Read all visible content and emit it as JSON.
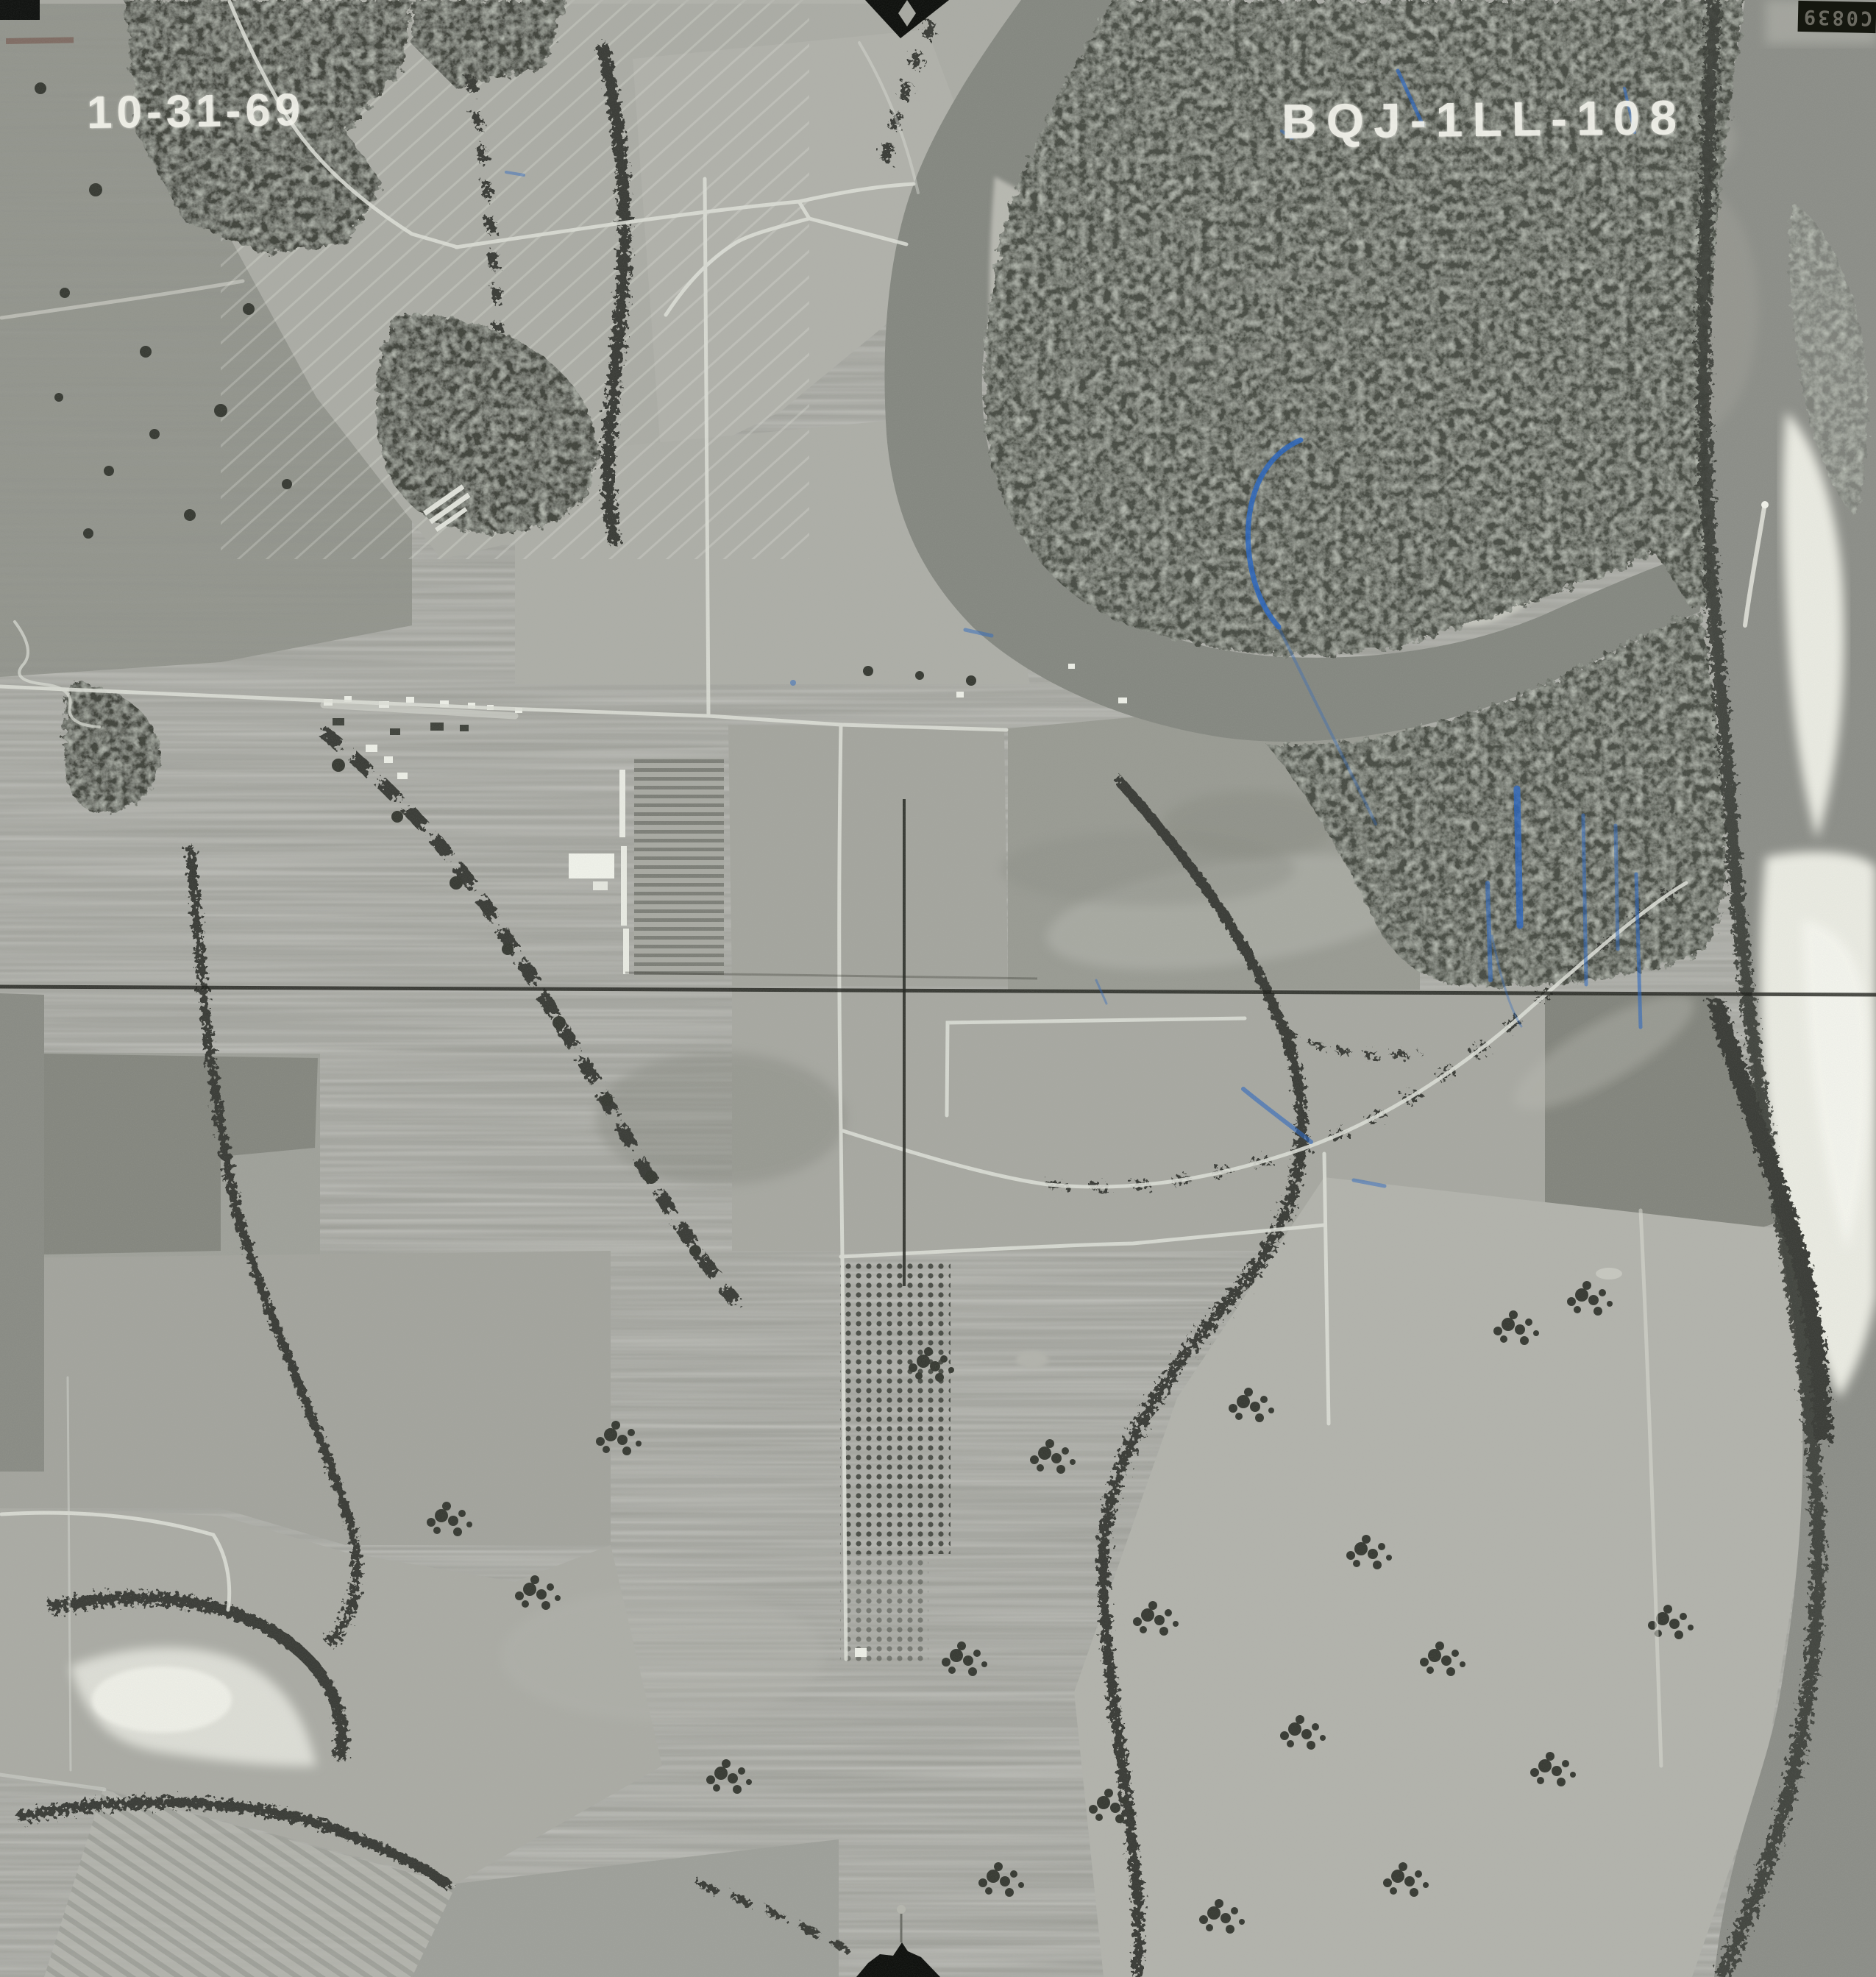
{
  "photo": {
    "date_stamp": "10-31-69",
    "photo_id_stamp": "BQJ-1LL-108",
    "film_edge_number": "C0839",
    "colors": {
      "stamp_white": "#f1f1ea",
      "ink_blue": "#2b67c0",
      "fiducial_black": "#0e100d",
      "water_gray": "#8c8e88",
      "oxbow_water_gray": "#858881",
      "sand_white": "#e9eae1",
      "forest_dark_gray": "#4a4d45",
      "field_light_gray": "#a6a7a1"
    }
  }
}
